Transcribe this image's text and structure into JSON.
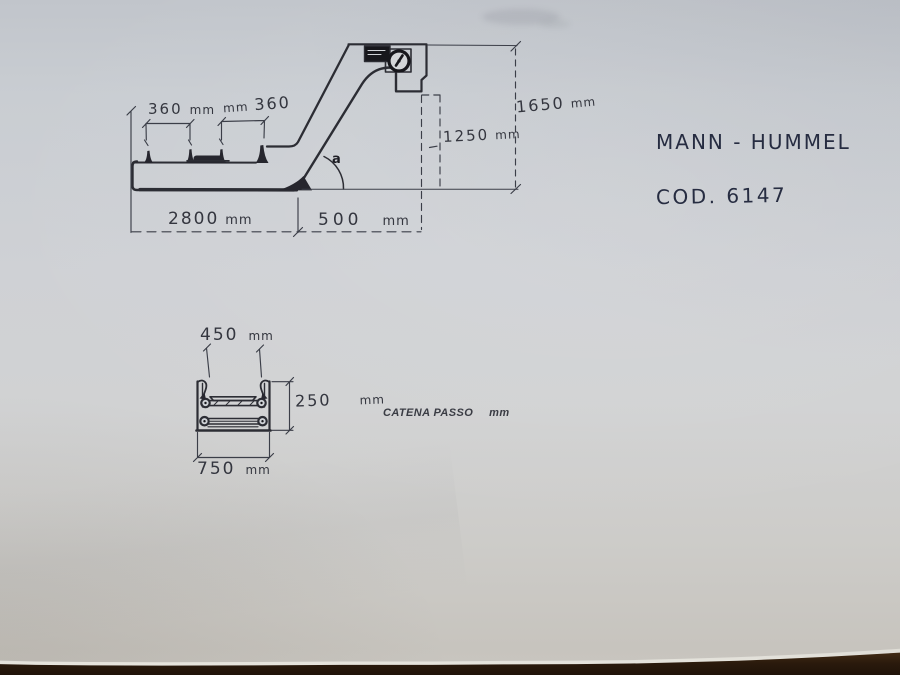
{
  "page": {
    "paper_color": "#cfd1d5",
    "ink_color": "#2c2d34",
    "table_color": "#2a1a0c"
  },
  "title_block": {
    "company": "MANN - HUMMEL",
    "code": "COD.  6147"
  },
  "side_view": {
    "angle_label": "a",
    "dims": {
      "pitch_left": {
        "value": "360",
        "unit": "mm"
      },
      "pitch_right": {
        "unit": "mm",
        "value": "360"
      },
      "total_height": {
        "value": "1650",
        "unit": "mm"
      },
      "discharge_height": {
        "value": "1250",
        "unit": "mm"
      },
      "horizontal_length": {
        "value": "2800",
        "unit": "mm"
      },
      "projection": {
        "value": "500",
        "unit": "mm"
      }
    }
  },
  "section_view": {
    "dims": {
      "top_width": {
        "value": "450",
        "unit": "mm"
      },
      "depth": {
        "value": "250",
        "unit": "mm"
      },
      "bottom_width": {
        "value": "750",
        "unit": "mm"
      }
    },
    "chain_pitch": {
      "label": "CATENA PASSO",
      "unit": "mm"
    }
  }
}
